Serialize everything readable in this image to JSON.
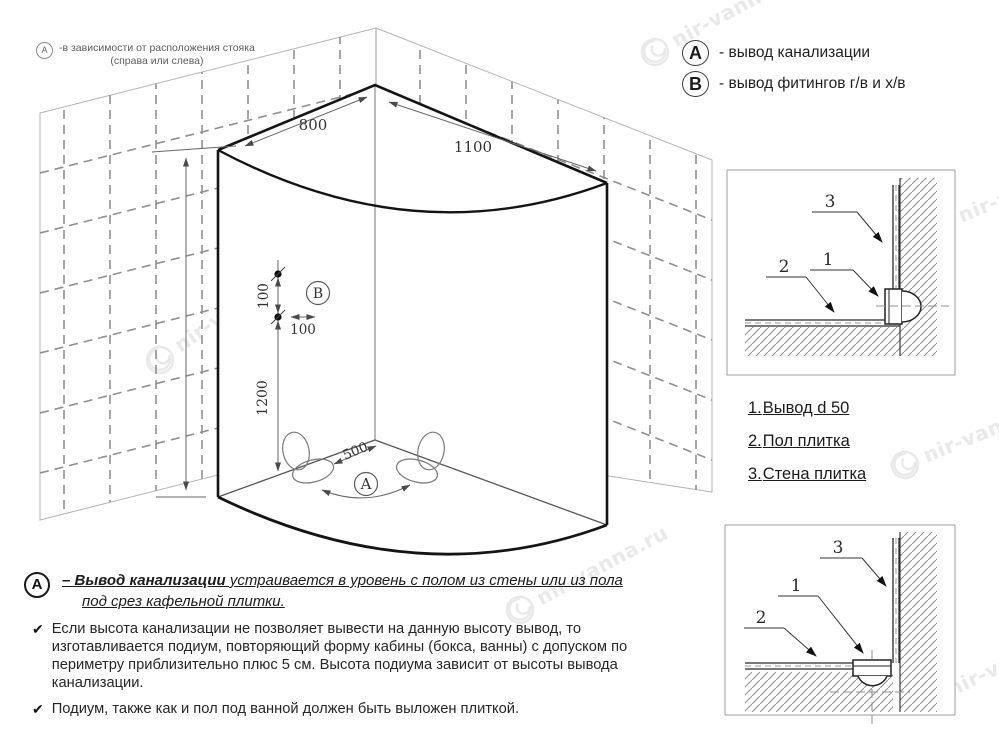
{
  "watermark": {
    "text": "nir-vanna.ru"
  },
  "note_top_left": {
    "marker": "A",
    "line1": "-в зависимости от расположения стояка",
    "line2": "(справа или слева)"
  },
  "legend": {
    "items": [
      {
        "marker": "A",
        "text": "- вывод канализации"
      },
      {
        "marker": "B",
        "text": "- вывод фитингов г/в и х/в"
      }
    ]
  },
  "diagram": {
    "dim_top_left": "800",
    "dim_top_right": "1100",
    "dim_b_vertical": "100",
    "dim_b_horizontal": "100",
    "dim_height": "1200",
    "dim_floor": "500",
    "marker_a": "A",
    "marker_b": "B"
  },
  "parts_list": {
    "items": [
      {
        "num": "1.",
        "label": "Вывод d 50"
      },
      {
        "num": "2.",
        "label": "Пол плитка"
      },
      {
        "num": "3.",
        "label": "Стена плитка"
      }
    ]
  },
  "detail_top": {
    "callout_wall": "3",
    "callout_pipe": "1",
    "callout_floor": "2"
  },
  "detail_bottom": {
    "callout_wall": "3",
    "callout_pipe": "1",
    "callout_floor": "2"
  },
  "footnote": {
    "marker": "A",
    "check": "✔",
    "title_bold": "– Вывод канализации",
    "title_rest": " устраивается в уровень с полом из стены или из пола",
    "title_line2": "под срез кафельной плитки.",
    "bullet1": "Если высота канализации не позволяет вывести на данную высоту вывод, то изготавливается подиум, повторяющий форму кабины (бокса, ванны) с допуском по периметру приблизительно плюс 5 см. Высота подиума зависит от высоты вывода канализации.",
    "bullet2": "Подиум, также как и пол под ванной должен быть выложен плиткой."
  }
}
